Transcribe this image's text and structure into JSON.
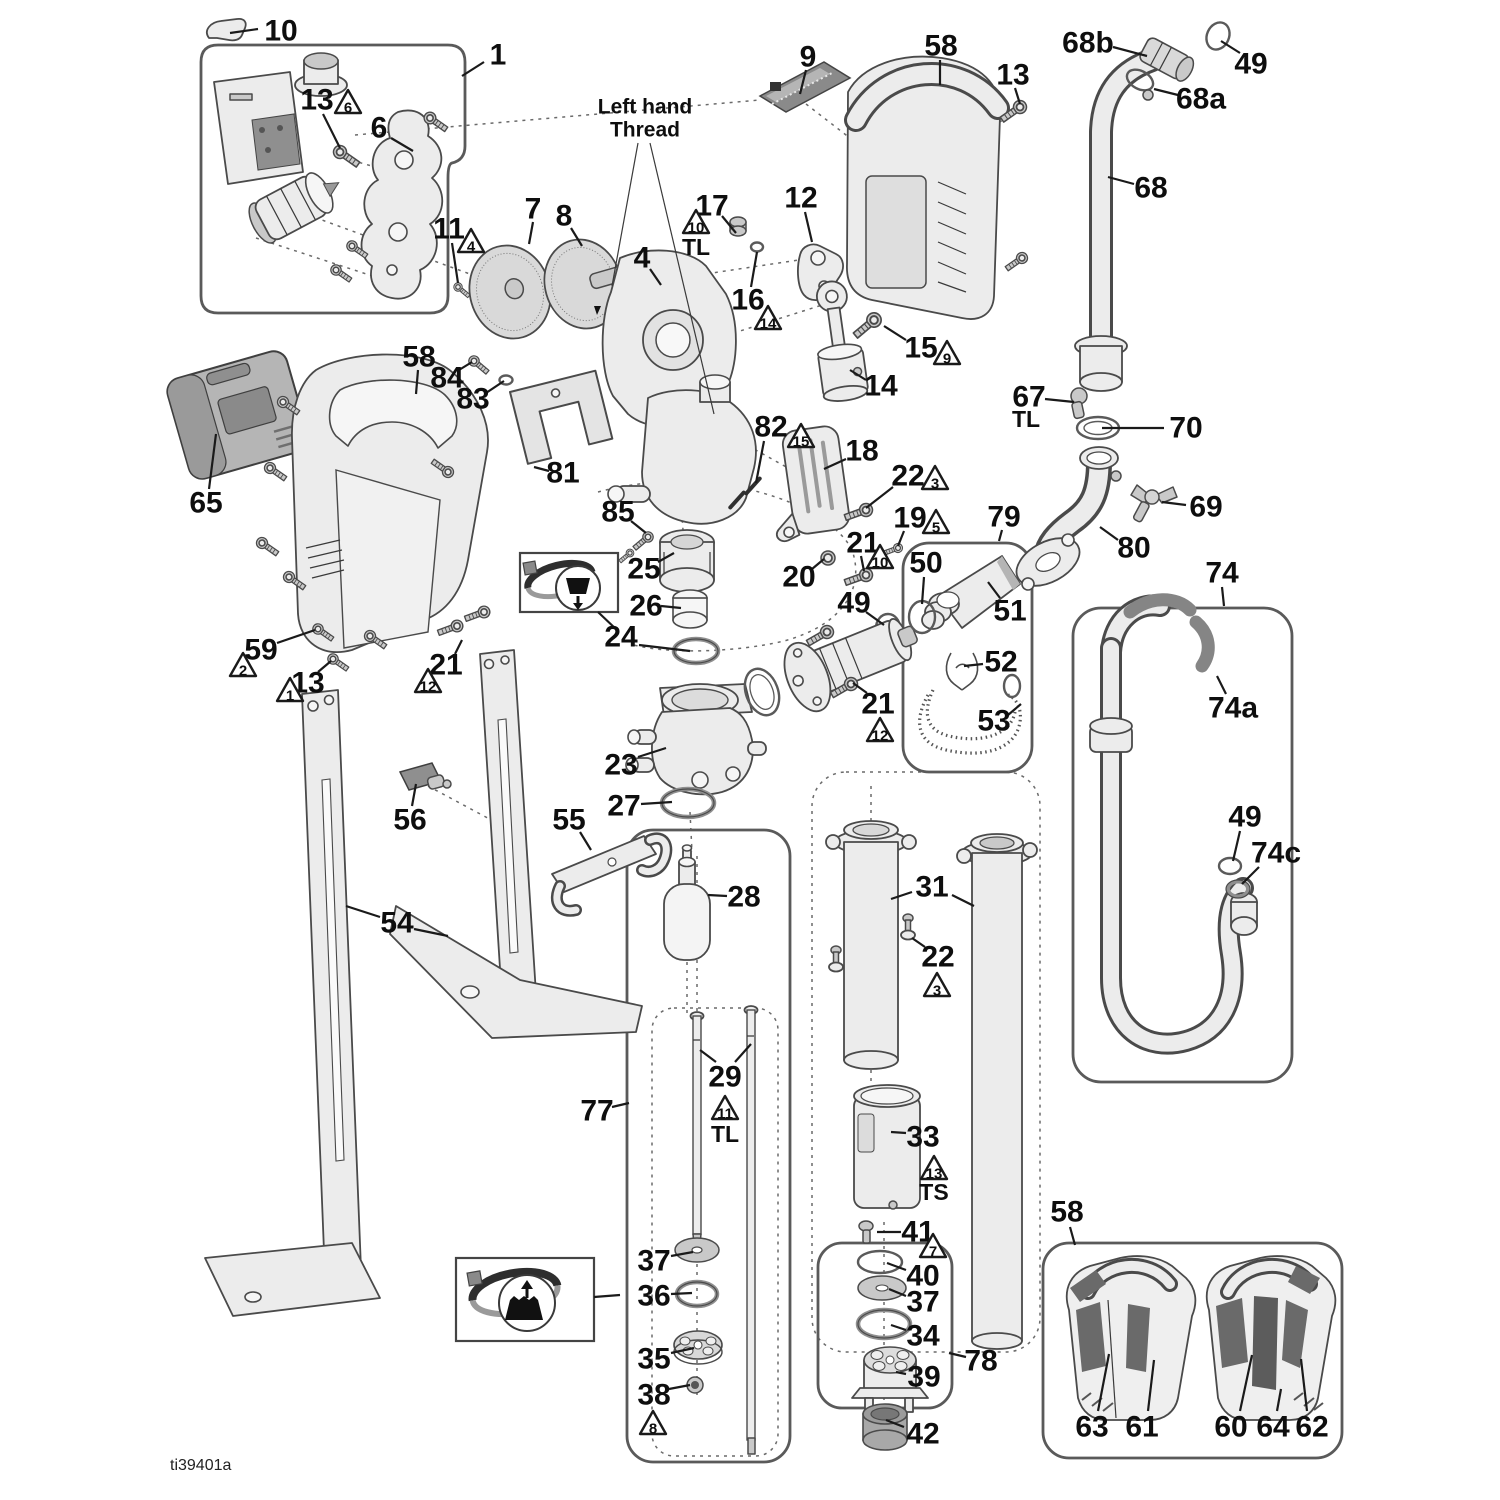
{
  "meta": {
    "drawing_id": "ti39401a"
  },
  "annotations": {
    "left_hand_thread_1": "Left hand",
    "left_hand_thread_2": "Thread"
  },
  "colors": {
    "line": "#4a4a4a",
    "fill": "#ececec",
    "pad": "#6a6a6a",
    "black": "#111111"
  },
  "callouts": [
    {
      "label": "10",
      "x": 281,
      "y": 31,
      "leaders": [
        [
          258,
          29,
          230,
          33
        ]
      ]
    },
    {
      "label": "1",
      "x": 498,
      "y": 55,
      "leaders": [
        [
          484,
          62,
          462,
          76
        ]
      ]
    },
    {
      "label": "13",
      "x": 317,
      "y": 100,
      "tri": {
        "n": "6",
        "x": 348,
        "y": 104
      },
      "leaders": [
        [
          323,
          114,
          340,
          148
        ]
      ]
    },
    {
      "label": "6",
      "x": 379,
      "y": 128,
      "leaders": [
        [
          391,
          138,
          413,
          151
        ]
      ]
    },
    {
      "label": "9",
      "x": 808,
      "y": 57,
      "leaders": [
        [
          806,
          70,
          800,
          94
        ]
      ]
    },
    {
      "label": "58",
      "x": 941,
      "y": 46,
      "leaders": [
        [
          940,
          60,
          940,
          85
        ]
      ]
    },
    {
      "label": "13",
      "x": 1013,
      "y": 75,
      "leaders": [
        [
          1015,
          88,
          1020,
          104
        ]
      ]
    },
    {
      "label": "68b",
      "x": 1088,
      "y": 43,
      "leaders": [
        [
          1113,
          47,
          1147,
          56
        ]
      ]
    },
    {
      "label": "49",
      "x": 1251,
      "y": 64,
      "leaders": [
        [
          1240,
          53,
          1221,
          41
        ]
      ]
    },
    {
      "label": "68a",
      "x": 1201,
      "y": 99,
      "leaders": [
        [
          1178,
          95,
          1154,
          89
        ]
      ]
    },
    {
      "label": "68",
      "x": 1151,
      "y": 188,
      "leaders": [
        [
          1134,
          184,
          1108,
          177
        ]
      ]
    },
    {
      "label": "7",
      "x": 533,
      "y": 209,
      "leaders": [
        [
          533,
          222,
          529,
          244
        ]
      ]
    },
    {
      "label": "8",
      "x": 564,
      "y": 216,
      "leaders": [
        [
          571,
          228,
          582,
          246
        ]
      ]
    },
    {
      "label": "17",
      "x": 712,
      "y": 206,
      "tri": {
        "n": "10",
        "x": 696,
        "y": 224
      },
      "note": {
        "t": "TL",
        "x": 696,
        "y": 247
      },
      "leaders": [
        [
          722,
          216,
          736,
          233
        ]
      ]
    },
    {
      "label": "12",
      "x": 801,
      "y": 198,
      "leaders": [
        [
          805,
          212,
          812,
          242
        ]
      ]
    },
    {
      "label": "4",
      "x": 642,
      "y": 258,
      "leaders": [
        [
          650,
          269,
          661,
          285
        ]
      ]
    },
    {
      "label": "16",
      "x": 748,
      "y": 300,
      "tri": {
        "n": "14",
        "x": 768,
        "y": 320
      },
      "leaders": [
        [
          751,
          287,
          757,
          252
        ]
      ]
    },
    {
      "label": "15",
      "x": 921,
      "y": 348,
      "tri": {
        "n": "9",
        "x": 947,
        "y": 355
      },
      "leaders": [
        [
          906,
          340,
          884,
          326
        ]
      ]
    },
    {
      "label": "14",
      "x": 881,
      "y": 386,
      "leaders": [
        [
          866,
          380,
          850,
          370
        ]
      ]
    },
    {
      "label": "58",
      "x": 419,
      "y": 357,
      "leaders": [
        [
          418,
          370,
          416,
          394
        ]
      ]
    },
    {
      "label": "84",
      "x": 447,
      "y": 378,
      "leaders": [
        [
          459,
          370,
          472,
          362
        ]
      ]
    },
    {
      "label": "83",
      "x": 473,
      "y": 399,
      "leaders": [
        [
          486,
          393,
          504,
          381
        ]
      ]
    },
    {
      "label": "81",
      "x": 563,
      "y": 473,
      "leaders": [
        [
          549,
          471,
          534,
          467
        ]
      ]
    },
    {
      "label": "65",
      "x": 206,
      "y": 503,
      "leaders": [
        [
          209,
          489,
          216,
          434
        ]
      ]
    },
    {
      "label": "85",
      "x": 618,
      "y": 512,
      "leaders": [
        [
          631,
          521,
          646,
          533
        ]
      ]
    },
    {
      "label": "25",
      "x": 644,
      "y": 569,
      "leaders": [
        [
          658,
          562,
          674,
          553
        ]
      ]
    },
    {
      "label": "26",
      "x": 646,
      "y": 606,
      "leaders": [
        [
          661,
          606,
          681,
          608
        ]
      ]
    },
    {
      "label": "24",
      "x": 621,
      "y": 637,
      "leaders": [
        [
          639,
          645,
          690,
          651
        ]
      ]
    },
    {
      "label": "82",
      "x": 771,
      "y": 427,
      "tri": {
        "n": "15",
        "x": 801,
        "y": 438
      },
      "leaders": [
        [
          764,
          441,
          756,
          483
        ]
      ]
    },
    {
      "label": "18",
      "x": 862,
      "y": 451,
      "leaders": [
        [
          846,
          459,
          824,
          469
        ]
      ]
    },
    {
      "label": "22",
      "x": 908,
      "y": 476,
      "tri": {
        "n": "3",
        "x": 935,
        "y": 480
      },
      "leaders": [
        [
          893,
          487,
          866,
          508
        ]
      ]
    },
    {
      "label": "19",
      "x": 910,
      "y": 518,
      "tri": {
        "n": "5",
        "x": 936,
        "y": 524
      },
      "leaders": [
        [
          904,
          531,
          898,
          546
        ]
      ]
    },
    {
      "label": "21",
      "x": 863,
      "y": 543,
      "tri": {
        "n": "10",
        "x": 880,
        "y": 559
      },
      "leaders": [
        [
          861,
          556,
          864,
          571
        ]
      ]
    },
    {
      "label": "20",
      "x": 799,
      "y": 577,
      "leaders": [
        [
          812,
          569,
          824,
          559
        ]
      ]
    },
    {
      "label": "49",
      "x": 854,
      "y": 603,
      "leaders": [
        [
          866,
          612,
          884,
          625
        ]
      ]
    },
    {
      "label": "79",
      "x": 1004,
      "y": 517,
      "leaders": [
        [
          1002,
          530,
          999,
          541
        ]
      ]
    },
    {
      "label": "50",
      "x": 926,
      "y": 563,
      "leaders": [
        [
          924,
          577,
          922,
          604
        ]
      ]
    },
    {
      "label": "51",
      "x": 1010,
      "y": 611,
      "leaders": [
        [
          1000,
          598,
          988,
          582
        ]
      ]
    },
    {
      "label": "52",
      "x": 1001,
      "y": 662,
      "leaders": [
        [
          983,
          664,
          964,
          666
        ]
      ]
    },
    {
      "label": "53",
      "x": 994,
      "y": 721,
      "leaders": [
        [
          1008,
          715,
          1021,
          704
        ]
      ]
    },
    {
      "label": "67",
      "x": 1029,
      "y": 397,
      "note": {
        "t": "TL",
        "x": 1026,
        "y": 419
      },
      "leaders": [
        [
          1045,
          399,
          1074,
          402
        ]
      ]
    },
    {
      "label": "70",
      "x": 1186,
      "y": 428,
      "leaders": [
        [
          1164,
          428,
          1102,
          428
        ]
      ]
    },
    {
      "label": "69",
      "x": 1206,
      "y": 507,
      "leaders": [
        [
          1186,
          505,
          1162,
          502
        ]
      ]
    },
    {
      "label": "80",
      "x": 1134,
      "y": 548,
      "leaders": [
        [
          1118,
          540,
          1100,
          527
        ]
      ]
    },
    {
      "label": "74",
      "x": 1222,
      "y": 573,
      "leaders": [
        [
          1222,
          587,
          1224,
          606
        ]
      ]
    },
    {
      "label": "74a",
      "x": 1233,
      "y": 708,
      "leaders": [
        [
          1226,
          694,
          1217,
          676
        ]
      ]
    },
    {
      "label": "49",
      "x": 1245,
      "y": 817,
      "leaders": [
        [
          1240,
          831,
          1233,
          861
        ]
      ]
    },
    {
      "label": "74c",
      "x": 1276,
      "y": 853,
      "leaders": [
        [
          1259,
          867,
          1242,
          884
        ]
      ]
    },
    {
      "label": "59",
      "x": 261,
      "y": 650,
      "tri": {
        "n": "2",
        "x": 243,
        "y": 667
      },
      "leaders": [
        [
          277,
          643,
          315,
          630
        ]
      ]
    },
    {
      "label": "13",
      "x": 308,
      "y": 683,
      "tri": {
        "n": "1",
        "x": 290,
        "y": 692
      },
      "leaders": [
        [
          318,
          672,
          331,
          661
        ]
      ]
    },
    {
      "label": "21",
      "x": 446,
      "y": 665,
      "tri": {
        "n": "12",
        "x": 428,
        "y": 683
      },
      "leaders": [
        [
          455,
          654,
          462,
          640
        ]
      ]
    },
    {
      "label": "56",
      "x": 410,
      "y": 820,
      "leaders": [
        [
          412,
          806,
          416,
          784
        ]
      ]
    },
    {
      "label": "55",
      "x": 569,
      "y": 820,
      "leaders": [
        [
          580,
          832,
          591,
          850
        ]
      ]
    },
    {
      "label": "54",
      "x": 397,
      "y": 923,
      "leaders": [
        [
          380,
          917,
          346,
          906
        ],
        [
          414,
          929,
          448,
          936
        ]
      ]
    },
    {
      "label": "23",
      "x": 621,
      "y": 765,
      "leaders": [
        [
          638,
          757,
          666,
          748
        ]
      ]
    },
    {
      "label": "27",
      "x": 624,
      "y": 806,
      "leaders": [
        [
          641,
          804,
          672,
          802
        ]
      ]
    },
    {
      "label": "28",
      "x": 744,
      "y": 897,
      "leaders": [
        [
          727,
          896,
          708,
          895
        ]
      ]
    },
    {
      "label": "29",
      "x": 725,
      "y": 1077,
      "tri": {
        "n": "11",
        "x": 725,
        "y": 1110
      },
      "note": {
        "t": "TL",
        "x": 725,
        "y": 1134
      },
      "leaders": [
        [
          716,
          1062,
          700,
          1050
        ],
        [
          735,
          1062,
          751,
          1044
        ]
      ]
    },
    {
      "label": "77",
      "x": 597,
      "y": 1111,
      "leaders": [
        [
          612,
          1107,
          629,
          1103
        ]
      ]
    },
    {
      "label": "31",
      "x": 932,
      "y": 887,
      "leaders": [
        [
          912,
          892,
          891,
          899
        ],
        [
          952,
          895,
          974,
          906
        ]
      ]
    },
    {
      "label": "22",
      "x": 938,
      "y": 957,
      "tri": {
        "n": "3",
        "x": 937,
        "y": 987
      },
      "leaders": [
        [
          925,
          947,
          912,
          938
        ]
      ]
    },
    {
      "label": "33",
      "x": 923,
      "y": 1137,
      "tri": {
        "n": "13",
        "x": 934,
        "y": 1170
      },
      "note": {
        "t": "TS",
        "x": 934,
        "y": 1192
      },
      "leaders": [
        [
          906,
          1133,
          891,
          1132
        ]
      ]
    },
    {
      "label": "41",
      "x": 918,
      "y": 1232,
      "tri": {
        "n": "7",
        "x": 933,
        "y": 1248
      },
      "leaders": [
        [
          901,
          1232,
          877,
          1232
        ]
      ]
    },
    {
      "label": "40",
      "x": 923,
      "y": 1276,
      "leaders": [
        [
          906,
          1270,
          887,
          1263
        ]
      ]
    },
    {
      "label": "37",
      "x": 923,
      "y": 1302,
      "leaders": [
        [
          906,
          1296,
          889,
          1289
        ]
      ]
    },
    {
      "label": "34",
      "x": 923,
      "y": 1336,
      "leaders": [
        [
          906,
          1330,
          891,
          1325
        ]
      ]
    },
    {
      "label": "39",
      "x": 924,
      "y": 1377,
      "leaders": [
        [
          906,
          1374,
          896,
          1372
        ]
      ]
    },
    {
      "label": "78",
      "x": 981,
      "y": 1361,
      "leaders": [
        [
          966,
          1357,
          949,
          1353
        ]
      ]
    },
    {
      "label": "42",
      "x": 923,
      "y": 1434,
      "leaders": [
        [
          904,
          1427,
          886,
          1420
        ]
      ]
    },
    {
      "label": "58",
      "x": 1067,
      "y": 1212,
      "leaders": [
        [
          1070,
          1227,
          1075,
          1245
        ]
      ]
    },
    {
      "label": "63",
      "x": 1092,
      "y": 1427,
      "leaders": [
        [
          1098,
          1411,
          1109,
          1354
        ]
      ]
    },
    {
      "label": "61",
      "x": 1142,
      "y": 1427,
      "leaders": [
        [
          1148,
          1411,
          1154,
          1360
        ]
      ]
    },
    {
      "label": "60",
      "x": 1231,
      "y": 1427,
      "leaders": [
        [
          1240,
          1411,
          1252,
          1355
        ]
      ]
    },
    {
      "label": "64",
      "x": 1273,
      "y": 1427,
      "leaders": [
        [
          1277,
          1411,
          1281,
          1389
        ]
      ]
    },
    {
      "label": "62",
      "x": 1312,
      "y": 1427,
      "leaders": [
        [
          1307,
          1411,
          1301,
          1359
        ]
      ]
    },
    {
      "label": "37",
      "x": 654,
      "y": 1261,
      "leaders": [
        [
          671,
          1256,
          693,
          1252
        ]
      ]
    },
    {
      "label": "36",
      "x": 654,
      "y": 1296,
      "leaders": [
        [
          671,
          1294,
          692,
          1293
        ]
      ]
    },
    {
      "label": "35",
      "x": 654,
      "y": 1359,
      "leaders": [
        [
          671,
          1353,
          694,
          1348
        ]
      ]
    },
    {
      "label": "38",
      "x": 654,
      "y": 1395,
      "tri": {
        "n": "8",
        "x": 653,
        "y": 1425
      },
      "leaders": [
        [
          669,
          1389,
          690,
          1385
        ]
      ]
    },
    {
      "label": "11",
      "x": 449,
      "y": 229,
      "tri": {
        "n": "4",
        "x": 471,
        "y": 243
      },
      "leaders": [
        [
          452,
          243,
          458,
          283
        ]
      ]
    },
    {
      "label": "21",
      "x": 878,
      "y": 704,
      "tri": {
        "n": "12",
        "x": 880,
        "y": 732
      },
      "leaders": [
        [
          867,
          693,
          853,
          683
        ]
      ]
    }
  ]
}
